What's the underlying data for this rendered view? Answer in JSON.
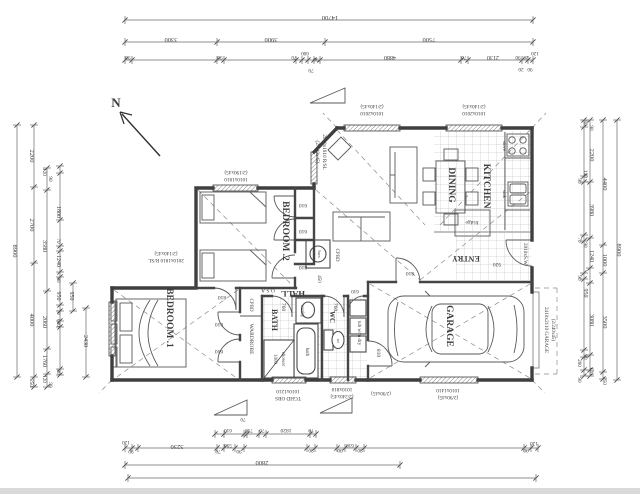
{
  "colors": {
    "paper": "#ffffff",
    "ink": "#3f3f3f",
    "dim_ink": "#555555",
    "tile_line": "#9a9a9a"
  },
  "north": {
    "t": "N",
    "x": 116,
    "y": 107,
    "r": 0,
    "s": 13,
    "b": true
  },
  "rooms": [
    {
      "t": "BEDROOM .1",
      "x": 167,
      "y": 318,
      "r": 90,
      "s": 9.5,
      "b": true
    },
    {
      "t": "BEDROOM .2",
      "x": 283,
      "y": 231,
      "r": 90,
      "s": 9.5,
      "b": true
    },
    {
      "t": "DINING",
      "x": 449,
      "y": 185,
      "r": 90,
      "s": 9.5,
      "b": true
    },
    {
      "t": "KITCHEN",
      "x": 484,
      "y": 186,
      "r": 90,
      "s": 9.5,
      "b": true
    },
    {
      "t": "GARAGE",
      "x": 447,
      "y": 326,
      "r": 90,
      "s": 9.5,
      "b": true
    },
    {
      "t": "BATH",
      "x": 272,
      "y": 320,
      "r": 90,
      "s": 8,
      "b": true
    },
    {
      "t": "WC",
      "x": 330,
      "y": 317,
      "r": 90,
      "s": 7,
      "b": true
    },
    {
      "t": "HALL",
      "x": 293,
      "y": 291,
      "r": 180,
      "s": 8.5,
      "b": true
    },
    {
      "t": "ENTRY",
      "x": 466,
      "y": 256,
      "r": 180,
      "s": 8,
      "b": true
    }
  ],
  "fixtures": [
    {
      "t": "WARDROBE",
      "x": 250,
      "y": 339,
      "r": 90,
      "s": 5.5
    },
    {
      "t": "CPBD",
      "x": 250,
      "y": 305,
      "r": 90,
      "s": 5
    },
    {
      "t": "CPBD",
      "x": 336,
      "y": 255,
      "r": 90,
      "s": 5
    },
    {
      "t": "hws",
      "x": 318,
      "y": 254,
      "r": 90,
      "s": 4.5
    },
    {
      "t": "450",
      "x": 318,
      "y": 279,
      "r": 90,
      "s": 5
    },
    {
      "t": "O.S.A",
      "x": 268,
      "y": 289,
      "r": 180,
      "s": 5.5
    },
    {
      "t": "bath",
      "x": 306,
      "y": 352,
      "r": 90,
      "s": 5
    },
    {
      "t": "vanity",
      "x": 301,
      "y": 311,
      "r": 90,
      "s": 5
    },
    {
      "t": "shower",
      "x": 282,
      "y": 359,
      "r": 90,
      "s": 5
    },
    {
      "t": "1000",
      "x": 274,
      "y": 359,
      "r": 90,
      "s": 5
    },
    {
      "t": "wc",
      "x": 337,
      "y": 341,
      "r": 90,
      "s": 4
    },
    {
      "t": "tub w/m dry",
      "x": 358,
      "y": 333,
      "r": 90,
      "s": 5
    },
    {
      "t": "fridge",
      "x": 472,
      "y": 221,
      "r": 180,
      "s": 5.5
    },
    {
      "t": "stove",
      "x": 503,
      "y": 146,
      "r": 90,
      "s": 4.8
    },
    {
      "t": "sink",
      "x": 503,
      "y": 194,
      "r": 90,
      "s": 4.8
    }
  ],
  "doors": [
    {
      "t": "810",
      "x": 222,
      "y": 296,
      "r": 180,
      "s": 5.5
    },
    {
      "t": "610",
      "x": 219,
      "y": 323,
      "r": 180,
      "s": 5.5
    },
    {
      "t": "610",
      "x": 219,
      "y": 350,
      "r": 180,
      "s": 5.5
    },
    {
      "t": "810",
      "x": 303,
      "y": 266,
      "r": 180,
      "s": 5.5
    },
    {
      "t": "610",
      "x": 303,
      "y": 204,
      "r": 180,
      "s": 5.5
    },
    {
      "t": "610",
      "x": 303,
      "y": 230,
      "r": 180,
      "s": 5.5
    },
    {
      "t": "760",
      "x": 282,
      "y": 307,
      "r": 90,
      "s": 5.5
    },
    {
      "t": "760",
      "x": 334,
      "y": 307,
      "r": 90,
      "s": 5.5
    },
    {
      "t": "610",
      "x": 355,
      "y": 290,
      "r": 180,
      "s": 5.2
    },
    {
      "t": "810",
      "x": 410,
      "y": 272,
      "r": 180,
      "s": 5.5
    },
    {
      "t": "810",
      "x": 377,
      "y": 353,
      "r": 90,
      "s": 5.5
    },
    {
      "t": "920",
      "x": 497,
      "y": 263,
      "r": 180,
      "s": 5.5
    }
  ],
  "windows": [
    {
      "t": "1010x1810",
      "x": 236,
      "y": 178,
      "r": 180,
      "s": 5.2
    },
    {
      "t": "(2/190x45)",
      "x": 236,
      "y": 171,
      "r": 180,
      "s": 5.2
    },
    {
      "t": "2010x1810 R/SL",
      "x": 323,
      "y": 152,
      "r": 90,
      "s": 5.2
    },
    {
      "t": "(2/140x45)",
      "x": 316,
      "y": 152,
      "r": 90,
      "s": 5.2
    },
    {
      "t": "1010x2010",
      "x": 372,
      "y": 112,
      "r": 180,
      "s": 5.2
    },
    {
      "t": "(2/140x45)",
      "x": 372,
      "y": 105,
      "r": 180,
      "s": 5.2
    },
    {
      "t": "1010x2010",
      "x": 474,
      "y": 112,
      "r": 180,
      "s": 5.2
    },
    {
      "t": "(2/140x45)",
      "x": 474,
      "y": 105,
      "r": 180,
      "s": 5.2
    },
    {
      "t": "2010x1810 R/SL",
      "x": 166,
      "y": 259,
      "r": 180,
      "s": 5.2
    },
    {
      "t": "(2/140x45)",
      "x": 166,
      "y": 252,
      "r": 180,
      "s": 5.2
    },
    {
      "t": "1010x1210",
      "x": 288,
      "y": 390,
      "r": 180,
      "s": 5.2
    },
    {
      "t": "TGHD OBS",
      "x": 288,
      "y": 397,
      "r": 180,
      "s": 5.2
    },
    {
      "t": "1010x810",
      "x": 342,
      "y": 388,
      "r": 180,
      "s": 5.2
    },
    {
      "t": "(2/240x45)",
      "x": 342,
      "y": 395,
      "r": 180,
      "s": 5.2
    },
    {
      "t": "(2/90x45)",
      "x": 381,
      "y": 392,
      "r": 180,
      "s": 5
    },
    {
      "t": "1010x1410",
      "x": 448,
      "y": 389,
      "r": 180,
      "s": 5.2
    },
    {
      "t": "(2/90x45)",
      "x": 448,
      "y": 396,
      "r": 180,
      "s": 5.2
    },
    {
      "t": "2010xS.W",
      "x": 524,
      "y": 254,
      "r": 90,
      "s": 5.2
    },
    {
      "t": "2410x2110 GARAGE",
      "x": 545,
      "y": 330,
      "r": 90,
      "s": 5.2
    },
    {
      "t": "(2/240x45)",
      "x": 552,
      "y": 330,
      "r": 90,
      "s": 5
    }
  ],
  "dimensions": {
    "top": [
      {
        "t": "14700",
        "x": 330,
        "y": 16
      },
      {
        "t": "3300",
        "x": 171,
        "y": 38
      },
      {
        "t": "3900",
        "x": 271,
        "y": 38
      },
      {
        "t": "7500",
        "x": 429,
        "y": 38
      },
      {
        "t": "90",
        "x": 128,
        "y": 56,
        "s": 5.2
      },
      {
        "t": "90",
        "x": 220,
        "y": 56,
        "s": 5.2
      },
      {
        "t": "70",
        "x": 294,
        "y": 56,
        "s": 5.2
      },
      {
        "t": "600",
        "x": 305,
        "y": 52,
        "s": 5.2
      },
      {
        "t": "90",
        "x": 316,
        "y": 58,
        "s": 5.2
      },
      {
        "t": "70",
        "x": 311,
        "y": 69,
        "s": 5.2
      },
      {
        "t": "4880",
        "x": 390,
        "y": 56,
        "s": 6
      },
      {
        "t": "70",
        "x": 464,
        "y": 56,
        "s": 5.2
      },
      {
        "t": "2130",
        "x": 493,
        "y": 56,
        "s": 6
      },
      {
        "t": "90",
        "x": 518,
        "y": 56,
        "s": 5.2
      },
      {
        "t": "20",
        "x": 526,
        "y": 56,
        "s": 5.2
      },
      {
        "t": "120",
        "x": 535,
        "y": 52,
        "s": 5.2
      },
      {
        "t": "20",
        "x": 521,
        "y": 68,
        "s": 5.2
      },
      {
        "t": "90",
        "x": 530,
        "y": 68,
        "s": 5.2
      }
    ],
    "bottom": [
      {
        "t": "70",
        "x": 243,
        "y": 418,
        "s": 5.2
      },
      {
        "t": "610",
        "x": 228,
        "y": 429,
        "s": 5.2
      },
      {
        "t": "730",
        "x": 249,
        "y": 429,
        "s": 5.2
      },
      {
        "t": "70",
        "x": 262,
        "y": 429,
        "s": 5.2
      },
      {
        "t": "1820",
        "x": 286,
        "y": 429,
        "s": 5.5
      },
      {
        "t": "70",
        "x": 311,
        "y": 429,
        "s": 5.2
      },
      {
        "t": "120",
        "x": 126,
        "y": 441,
        "s": 5.2
      },
      {
        "t": "90",
        "x": 131,
        "y": 450,
        "s": 5.2
      },
      {
        "t": "3230",
        "x": 177,
        "y": 445
      },
      {
        "t": "70",
        "x": 218,
        "y": 450,
        "s": 5.2
      },
      {
        "t": "590",
        "x": 228,
        "y": 444,
        "s": 5.2
      },
      {
        "t": "90",
        "x": 239,
        "y": 450,
        "s": 5.2
      },
      {
        "t": "90",
        "x": 311,
        "y": 449,
        "s": 5.2
      },
      {
        "t": "90",
        "x": 340,
        "y": 449,
        "s": 5.2
      },
      {
        "t": "610",
        "x": 350,
        "y": 444,
        "s": 5.2
      },
      {
        "t": "90",
        "x": 360,
        "y": 449,
        "s": 5.2
      },
      {
        "t": "90",
        "x": 526,
        "y": 449,
        "s": 5.2
      },
      {
        "t": "120",
        "x": 534,
        "y": 442,
        "s": 5.2
      },
      {
        "t": "2800",
        "x": 262,
        "y": 461
      }
    ],
    "left": [
      {
        "t": "8900",
        "x": 13,
        "y": 251
      },
      {
        "t": "2200",
        "x": 30,
        "y": 156
      },
      {
        "t": "2700",
        "x": 30,
        "y": 225
      },
      {
        "t": "4000",
        "x": 30,
        "y": 320
      },
      {
        "t": "250",
        "x": 30,
        "y": 383,
        "s": 5.2
      },
      {
        "t": "120",
        "x": 43,
        "y": 172,
        "s": 5.2
      },
      {
        "t": "90",
        "x": 49,
        "y": 179,
        "s": 5.2
      },
      {
        "t": "3580",
        "x": 43,
        "y": 246,
        "s": 6
      },
      {
        "t": "2060",
        "x": 43,
        "y": 322,
        "s": 6
      },
      {
        "t": "1760",
        "x": 43,
        "y": 361,
        "s": 6
      },
      {
        "t": "120",
        "x": 43,
        "y": 379,
        "s": 5.2
      },
      {
        "t": "90",
        "x": 49,
        "y": 385,
        "s": 5.2
      },
      {
        "t": "1800",
        "x": 57,
        "y": 212,
        "s": 6
      },
      {
        "t": "70",
        "x": 57,
        "y": 241,
        "s": 5.2
      },
      {
        "t": "1240",
        "x": 57,
        "y": 261,
        "s": 6
      },
      {
        "t": "90",
        "x": 57,
        "y": 280,
        "s": 5.2
      },
      {
        "t": "950",
        "x": 57,
        "y": 296,
        "s": 6
      },
      {
        "t": "70",
        "x": 57,
        "y": 312,
        "s": 5.2
      },
      {
        "t": "600",
        "x": 57,
        "y": 323,
        "s": 5.2
      },
      {
        "t": "90",
        "x": 57,
        "y": 372,
        "s": 5.2
      },
      {
        "t": "950",
        "x": 70,
        "y": 296,
        "s": 6
      },
      {
        "t": "2430",
        "x": 84,
        "y": 341,
        "s": 6
      }
    ],
    "right": [
      {
        "t": "8900",
        "x": 617,
        "y": 250
      },
      {
        "t": "4400",
        "x": 603,
        "y": 184
      },
      {
        "t": "1000",
        "x": 603,
        "y": 260
      },
      {
        "t": "3500",
        "x": 603,
        "y": 322
      },
      {
        "t": "250",
        "x": 603,
        "y": 381,
        "s": 5.2
      },
      {
        "t": "2200",
        "x": 590,
        "y": 155
      },
      {
        "t": "3980",
        "x": 590,
        "y": 210,
        "s": 6
      },
      {
        "t": "1240",
        "x": 590,
        "y": 256,
        "s": 6
      },
      {
        "t": "3080",
        "x": 590,
        "y": 320,
        "s": 6
      },
      {
        "t": "950",
        "x": 584,
        "y": 293,
        "s": 6
      },
      {
        "t": "80",
        "x": 584,
        "y": 123,
        "s": 5.2
      },
      {
        "t": "90",
        "x": 590,
        "y": 128,
        "s": 5.2
      },
      {
        "t": "120",
        "x": 584,
        "y": 174,
        "s": 5.2
      },
      {
        "t": "90",
        "x": 578,
        "y": 181,
        "s": 5.2
      },
      {
        "t": "70",
        "x": 578,
        "y": 240,
        "s": 5.2
      },
      {
        "t": "90",
        "x": 584,
        "y": 245,
        "s": 5.2
      },
      {
        "t": "90",
        "x": 578,
        "y": 278,
        "s": 5.2
      },
      {
        "t": "90",
        "x": 584,
        "y": 357,
        "s": 5.2
      },
      {
        "t": "280",
        "x": 578,
        "y": 363,
        "s": 5.2
      },
      {
        "t": "120",
        "x": 590,
        "y": 371,
        "s": 5.2
      },
      {
        "t": "90",
        "x": 578,
        "y": 380,
        "s": 5.2
      }
    ]
  }
}
